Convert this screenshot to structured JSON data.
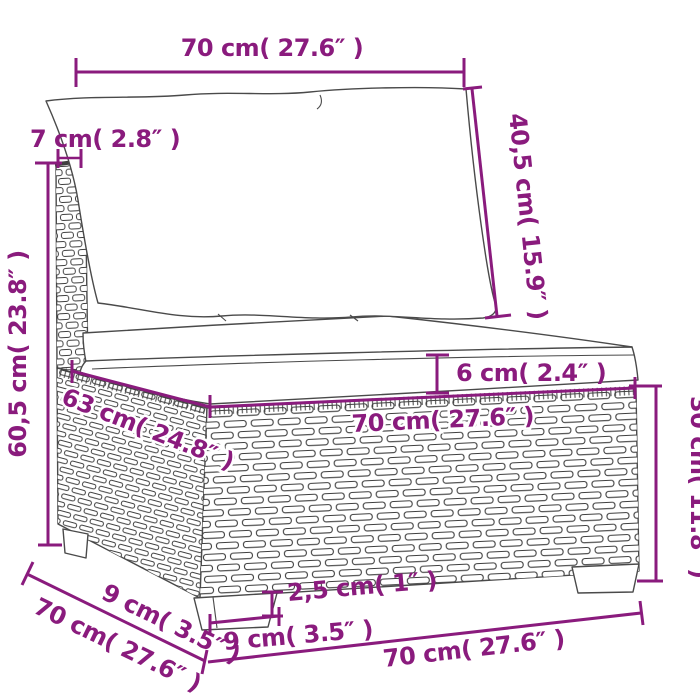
{
  "colors": {
    "accent": "#8A1B7D",
    "outline": "#4a4a4a",
    "wicker": "#3f3f3f",
    "background": "#ffffff"
  },
  "measurements": {
    "top_width": "70 cm( 27.6″ )",
    "back_panel_width": "7 cm( 2.8″ )",
    "overall_height": "60,5 cm( 23.8″ )",
    "back_cushion_height": "40,5 cm( 15.9″ )",
    "seat_cushion_thickness": "6 cm( 2.4″ )",
    "seat_depth": "63 cm( 24.8″ )",
    "seat_width": "70 cm( 27.6″ )",
    "base_height": "30 cm( 11.8″ )",
    "side_foot_height": "9 cm( 3.5″ )",
    "overall_depth": "70 cm( 27.6″ )",
    "foot_clearance": "2,5 cm( 1″ )",
    "foot_width": "9 cm( 3.5″ )",
    "overall_width": "70 cm( 27.6″ )"
  }
}
